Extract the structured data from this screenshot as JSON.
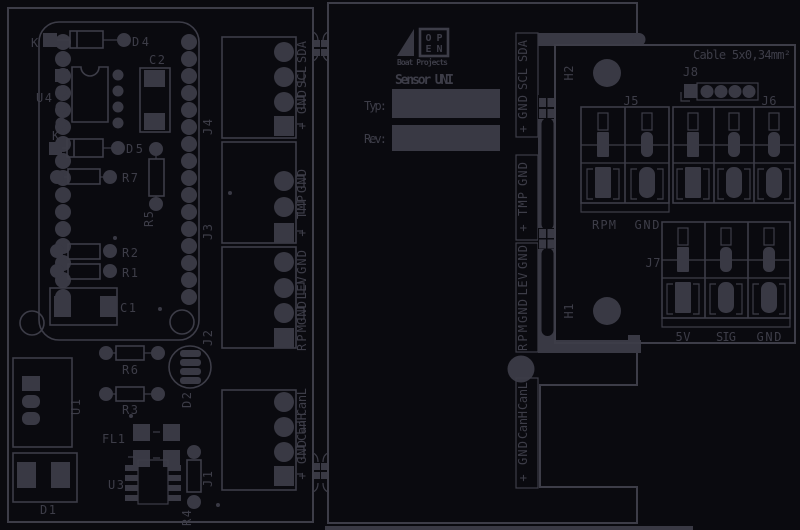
{
  "colors": {
    "background": "#0a0a0f",
    "silkscreen": "#3d3d48",
    "pad_fill": "#393944"
  },
  "left_board": {
    "module": {
      "u4": "U4",
      "k1": "K",
      "d4": "D4",
      "c2": "C2",
      "k2": "K",
      "d5": "D5",
      "r7": "R7",
      "r5": "R5",
      "r2": "R2",
      "r1": "R1",
      "c1": "C1"
    },
    "parts": {
      "r6": "R6",
      "r3": "R3",
      "d2": "D2",
      "u1": "U1",
      "fl1": "FL1",
      "u3": "U3",
      "r4": "R4",
      "d1": "D1"
    },
    "j4": {
      "ref": "J4",
      "pins": [
        "SDA",
        "SCL",
        "GND",
        "+"
      ]
    },
    "j3": {
      "ref": "J3",
      "pins": [
        "GND",
        "TMP",
        "+"
      ]
    },
    "j2": {
      "ref": "J2",
      "pins": [
        "GND",
        "LEV",
        "GND",
        "RPM"
      ]
    },
    "j1": {
      "ref": "J1",
      "pins": [
        "CanL",
        "CanH",
        "GND",
        "+"
      ]
    }
  },
  "middle_board": {
    "logo": {
      "top": "OP",
      "bottom": "EN",
      "subtitle": "Boat Projects"
    },
    "title": "Sensor UNI",
    "typ_label": "Typ:",
    "rev_label": "Rev:",
    "edge_groups": {
      "g1": [
        "SDA",
        "SCL",
        "GND",
        "+"
      ],
      "g2": [
        "GND",
        "TMP",
        "+"
      ],
      "g3": [
        "GND",
        "LEV",
        "GND",
        "RPM"
      ],
      "g4": [
        "CanL",
        "CanH",
        "GND",
        "+"
      ]
    }
  },
  "right_board": {
    "cable_note": "Cable 5x0,34mm²",
    "h2": "H2",
    "h1": "H1",
    "j8": "J8",
    "j5": "J5",
    "j6": "J6",
    "j7": "J7",
    "j5_labels": [
      "RPM",
      "GND"
    ],
    "j7_labels": [
      "5V",
      "SIG",
      "GND"
    ]
  }
}
